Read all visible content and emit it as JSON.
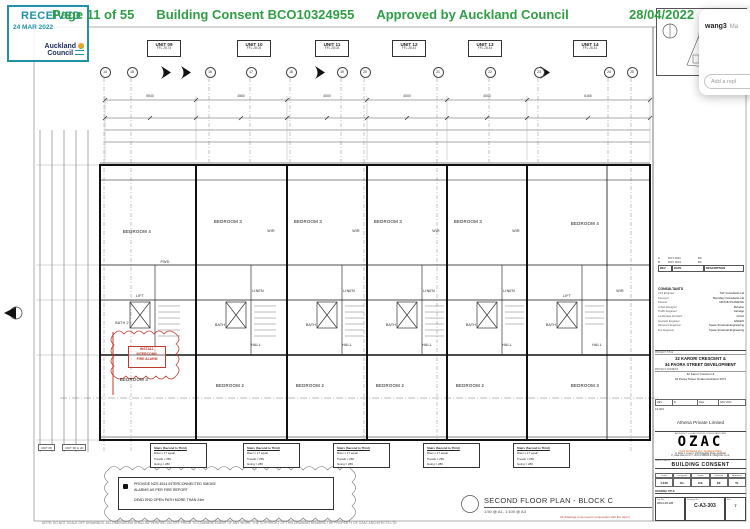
{
  "header": {
    "page": "Page 11 of 55",
    "consent": "Building Consent BCO10324955",
    "approved": "Approved by Auckland Council",
    "date": "28/04/2022"
  },
  "stamp": {
    "received": "RECEIVED",
    "date": "24 MAR 2022",
    "org1": "Auckland",
    "org2": "Council"
  },
  "overlay": {
    "username": "wang3",
    "preview": "Ma",
    "reply_placeholder": "Add a repl"
  },
  "units": [
    {
      "name": "UNIT 09",
      "ffl": "FFL 28.74"
    },
    {
      "name": "UNIT 10",
      "ffl": "FFL 28.04"
    },
    {
      "name": "UNIT 11",
      "ffl": "FFL 28.04"
    },
    {
      "name": "UNIT 12",
      "ffl": "FFL 28.44"
    },
    {
      "name": "UNIT 13",
      "ffl": "FFL 28.44"
    },
    {
      "name": "UNIT 14",
      "ffl": "FFL 28.44"
    }
  ],
  "grid_bubbles": [
    "14",
    "15",
    "16",
    "17",
    "18",
    "19",
    "20",
    "21",
    "22",
    "23",
    "24",
    "25"
  ],
  "dims_top": [
    "5540",
    "4560",
    "4000",
    "4000",
    "4000",
    "6160"
  ],
  "plan": {
    "rooms_top": [
      "BEDROOM 4",
      "BEDROOM 3",
      "BEDROOM 3",
      "BEDROOM 3",
      "BEDROOM 3",
      "BEDROOM 4"
    ],
    "rooms_bottom": [
      "BEDROOM 3",
      "BEDROOM 2",
      "BEDROOM 2",
      "BEDROOM 2",
      "BEDROOM 2",
      "BEDROOM 3"
    ],
    "labels": {
      "lift": "LIFT",
      "hall": "HALL",
      "linen": "LINEN",
      "bath": "BATH",
      "bath2": "BATH 2",
      "wir": "WIR",
      "pwd": "PWD",
      "wd": "WD"
    },
    "red_note": {
      "l1": "INSTALL",
      "l2": "INTERCONN.",
      "l3": "FIRE ALARM"
    }
  },
  "stair_note": {
    "l1": "Stairs (Second to Third)",
    "l2": "Riser x 17 equal",
    "l3": "Treads = 250",
    "l4": "Going = 280"
  },
  "smoke_note": {
    "l1": "PROVIDE NZS 4514 INTERCONNECTED SMOKE",
    "l2": "ALARMS AS PER FIRE REPORT",
    "l3": "DEAD END OPEN PATH MORE THAN 24m"
  },
  "footer": {
    "title": "SECOND FLOOR PLAN - BLOCK C",
    "scale": "1:50 @ A1, 1:100 @ A3",
    "red_note": "All drawings to be read in conjunction with fire report",
    "copyright": "NOTE: DO NOT SCALE OFF DRAWINGS. ALL DIMENSIONS SHALL BE VERIFIED ON SITE PRIOR TO COMMENCEMENT OF ANY WORK. THE COPYRIGHT OF THIS DRAWING REMAINS THE PROPERTY OF OZAC ARCHITECTS LTD.",
    "tag1": "UNIT 08",
    "tag2": "UNIT 3D & LD"
  },
  "titleblock": {
    "rev_rows": [
      {
        "rev": "A",
        "date": "OCT 2021",
        "desc": "BC"
      },
      {
        "rev": "B",
        "date": "NOV 2021",
        "desc": "BC"
      }
    ],
    "rev_head": {
      "rev": "REV",
      "date": "DATE",
      "desc": "DESCRIPTION"
    },
    "consultants_title": "CONSULTANTS",
    "consultants": [
      {
        "role": "Civil Engineer",
        "name": "T&T Consultants Ltd"
      },
      {
        "role": "Surveyor",
        "name": "Boundary Consultants Ltd"
      },
      {
        "role": "Planner",
        "name": "MATVIN PLANNING"
      },
      {
        "role": "Urban Designer",
        "name": "McIndoe"
      },
      {
        "role": "Traffic Engineer",
        "name": "Carriage"
      },
      {
        "role": "Landscape Architect",
        "name": "GOLA"
      },
      {
        "role": "Geotech Engineer",
        "name": "ENGEO"
      },
      {
        "role": "Structural Engineer",
        "name": "Space Structural Engineering"
      },
      {
        "role": "Fire Engineer",
        "name": "Space Structural Engineering"
      }
    ],
    "project_title_label": "PROJECT TITLE",
    "project_title1": "32 KARORI CRESCENT &",
    "project_title2": "34 PAORA STREET DEVELOPMENT",
    "project_address_label": "PROJECT ADDRESS",
    "project_address1": "32 Karori Crescent &",
    "project_address2": "34 Paora Street Orakei Auckland 1071",
    "mid_cells": [
      "REV",
      "B",
      "Date",
      "NOV 2021"
    ],
    "job_ref": "16.003",
    "client": "Athena Private Limited",
    "firm_label": "ARCHITECT & LEAD DESIGN CONSULTANT FIRM",
    "firm_logo": "OZAC",
    "firm_line1": "Ozac Architects Ltd - Auckland Office",
    "firm_line2": "A: Suite 1, Level 2, 102 Rosedale Road, Auckland",
    "firm_line3": "P: www.ozac.co.nz  T: +64 9 2158814  E: info@ozac.co.nz",
    "issue_label": "ISSUE STATUS",
    "issue_status": "BUILDING CONSENT",
    "sign_head": [
      "Scale",
      "Designed",
      "Drawn",
      "Checked",
      "Approved"
    ],
    "sign_vals": [
      "1:100",
      "KL",
      "KE",
      "KF",
      "TL"
    ],
    "drawing_title_label": "DRAWING TITLE",
    "job_label": "Job No",
    "job_no": "2004-20-HB",
    "dwg_label": "Drawing No",
    "dwg_no": "C-A3-303",
    "rev_label": "Rev",
    "rev_no": "7"
  }
}
